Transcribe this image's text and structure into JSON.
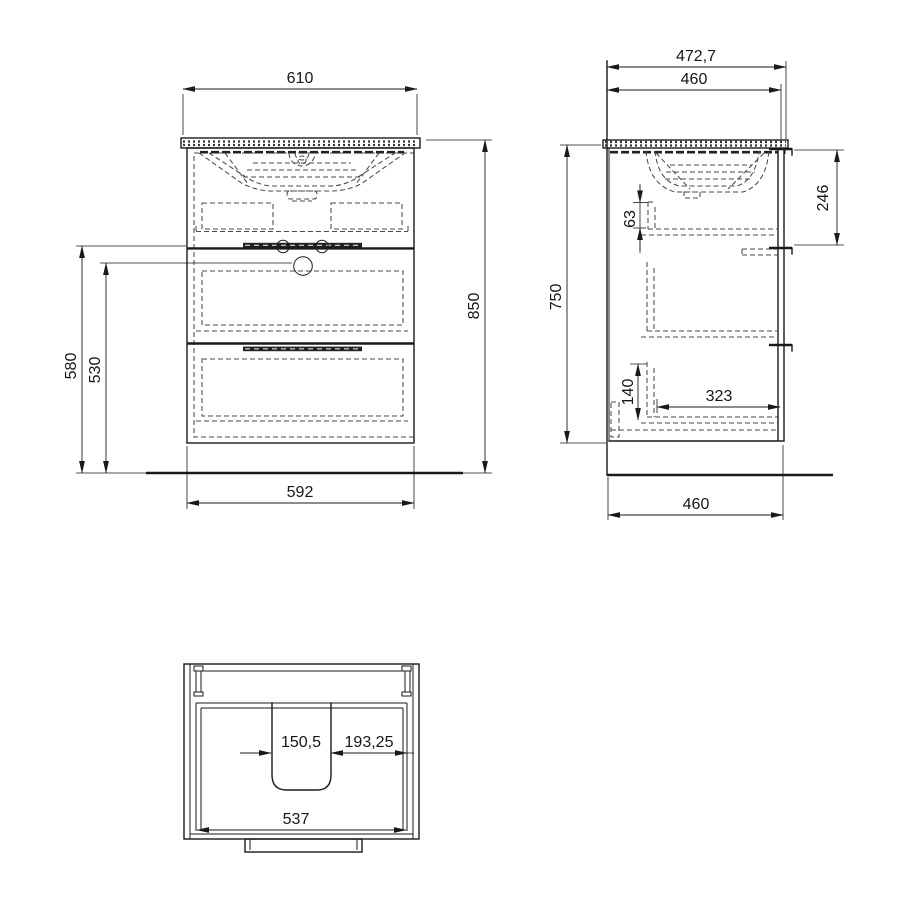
{
  "title": "Vanity unit technical drawing",
  "colors": {
    "line": "#1a1a1a",
    "dashed": "#4a4a4a",
    "background": "#ffffff"
  },
  "dims": {
    "front": {
      "width_top": "610",
      "height_overall": "850",
      "height_front_upper": "580",
      "height_front_inner": "530",
      "width_cabinet": "592"
    },
    "side": {
      "depth_overall": "472,7",
      "depth_countertop": "460",
      "height_side": "750",
      "offset_top": "63",
      "front_panel_upper": "246",
      "offset_bottom": "140",
      "depth_interior": "323",
      "depth_base": "460"
    },
    "plan": {
      "cutout_width": "150,5",
      "offset_right": "193,25",
      "width_interior": "537"
    }
  }
}
